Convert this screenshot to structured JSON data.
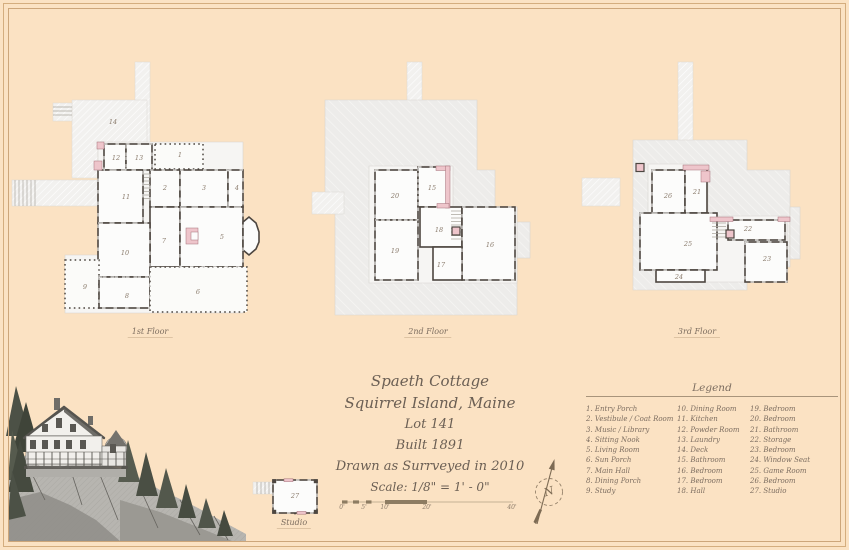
{
  "title_block": {
    "name": "Spaeth Cottage",
    "location": "Squirrel Island, Maine",
    "lot": "Lot 141",
    "built": "Built 1891",
    "survey": "Drawn as Surrveyed in 2010",
    "scale": "Scale: 1/8\" = 1' - 0\""
  },
  "plans": [
    {
      "label": "1st Floor",
      "label_pos": {
        "x": 150,
        "y": 327
      },
      "rooms": [
        {
          "n": "14",
          "x": 113,
          "y": 122
        },
        {
          "n": "12",
          "x": 116,
          "y": 158
        },
        {
          "n": "13",
          "x": 139,
          "y": 158
        },
        {
          "n": "1",
          "x": 180,
          "y": 155
        },
        {
          "n": "2",
          "x": 165,
          "y": 188
        },
        {
          "n": "3",
          "x": 204,
          "y": 188
        },
        {
          "n": "4",
          "x": 237,
          "y": 188
        },
        {
          "n": "11",
          "x": 126,
          "y": 197
        },
        {
          "n": "7",
          "x": 164,
          "y": 241
        },
        {
          "n": "5",
          "x": 222,
          "y": 237
        },
        {
          "n": "10",
          "x": 125,
          "y": 253
        },
        {
          "n": "9",
          "x": 85,
          "y": 287
        },
        {
          "n": "8",
          "x": 127,
          "y": 296
        },
        {
          "n": "6",
          "x": 198,
          "y": 292
        }
      ]
    },
    {
      "label": "2nd Floor",
      "label_pos": {
        "x": 428,
        "y": 327
      },
      "rooms": [
        {
          "n": "20",
          "x": 395,
          "y": 196
        },
        {
          "n": "15",
          "x": 432,
          "y": 188
        },
        {
          "n": "18",
          "x": 439,
          "y": 230
        },
        {
          "n": "19",
          "x": 395,
          "y": 251
        },
        {
          "n": "16",
          "x": 490,
          "y": 245
        },
        {
          "n": "17",
          "x": 441,
          "y": 265
        }
      ]
    },
    {
      "label": "3rd Floor",
      "label_pos": {
        "x": 697,
        "y": 327
      },
      "rooms": [
        {
          "n": "26",
          "x": 668,
          "y": 196
        },
        {
          "n": "21",
          "x": 697,
          "y": 192
        },
        {
          "n": "22",
          "x": 748,
          "y": 229
        },
        {
          "n": "25",
          "x": 688,
          "y": 244
        },
        {
          "n": "23",
          "x": 767,
          "y": 259
        },
        {
          "n": "24",
          "x": 679,
          "y": 277
        }
      ]
    },
    {
      "label": "Studio",
      "label_pos": {
        "x": 294,
        "y": 518
      },
      "rooms": [
        {
          "n": "27",
          "x": 295,
          "y": 496
        }
      ]
    }
  ],
  "legend": {
    "title": "Legend",
    "columns": [
      [
        {
          "num": "1.",
          "label": "Entry Porch"
        },
        {
          "num": "2.",
          "label": "Vestibule / Coat Room"
        },
        {
          "num": "3.",
          "label": "Music / Library"
        },
        {
          "num": "4.",
          "label": "Sitting Nook"
        },
        {
          "num": "5.",
          "label": "Living Room"
        },
        {
          "num": "6.",
          "label": "Sun Porch"
        },
        {
          "num": "7.",
          "label": "Main Hall"
        },
        {
          "num": "8.",
          "label": "Dining Porch"
        },
        {
          "num": "9.",
          "label": "Study"
        }
      ],
      [
        {
          "num": "10.",
          "label": "Dining Room"
        },
        {
          "num": "11.",
          "label": "Kitchen"
        },
        {
          "num": "12.",
          "label": "Powder Room"
        },
        {
          "num": "13.",
          "label": "Laundry"
        },
        {
          "num": "14.",
          "label": "Deck"
        },
        {
          "num": "15.",
          "label": "Bathroom"
        },
        {
          "num": "16.",
          "label": "Bedroom"
        },
        {
          "num": "17.",
          "label": "Bedroom"
        },
        {
          "num": "18.",
          "label": "Hall"
        }
      ],
      [
        {
          "num": "19.",
          "label": "Bedroom"
        },
        {
          "num": "20.",
          "label": "Bedroom"
        },
        {
          "num": "21.",
          "label": "Bathroom"
        },
        {
          "num": "22.",
          "label": "Storage"
        },
        {
          "num": "23.",
          "label": "Bedroom"
        },
        {
          "num": "24.",
          "label": "Window Seat"
        },
        {
          "num": "25.",
          "label": "Game Room"
        },
        {
          "num": "26.",
          "label": "Bedroom"
        },
        {
          "num": "27.",
          "label": "Studio"
        }
      ]
    ]
  },
  "scale_bar": {
    "ticks": [
      {
        "t": "0'",
        "x": 342
      },
      {
        "t": "5'",
        "x": 364
      },
      {
        "t": "10'",
        "x": 385
      },
      {
        "t": "20'",
        "x": 427
      },
      {
        "t": "40'",
        "x": 512
      }
    ]
  },
  "compass": {
    "letter": "N"
  },
  "colors": {
    "background": "#fbe2c3",
    "frame": "#cda67a",
    "wall": "#4d4640",
    "chimney_pink": "#eec5cb",
    "ink": "#6b5f54"
  }
}
